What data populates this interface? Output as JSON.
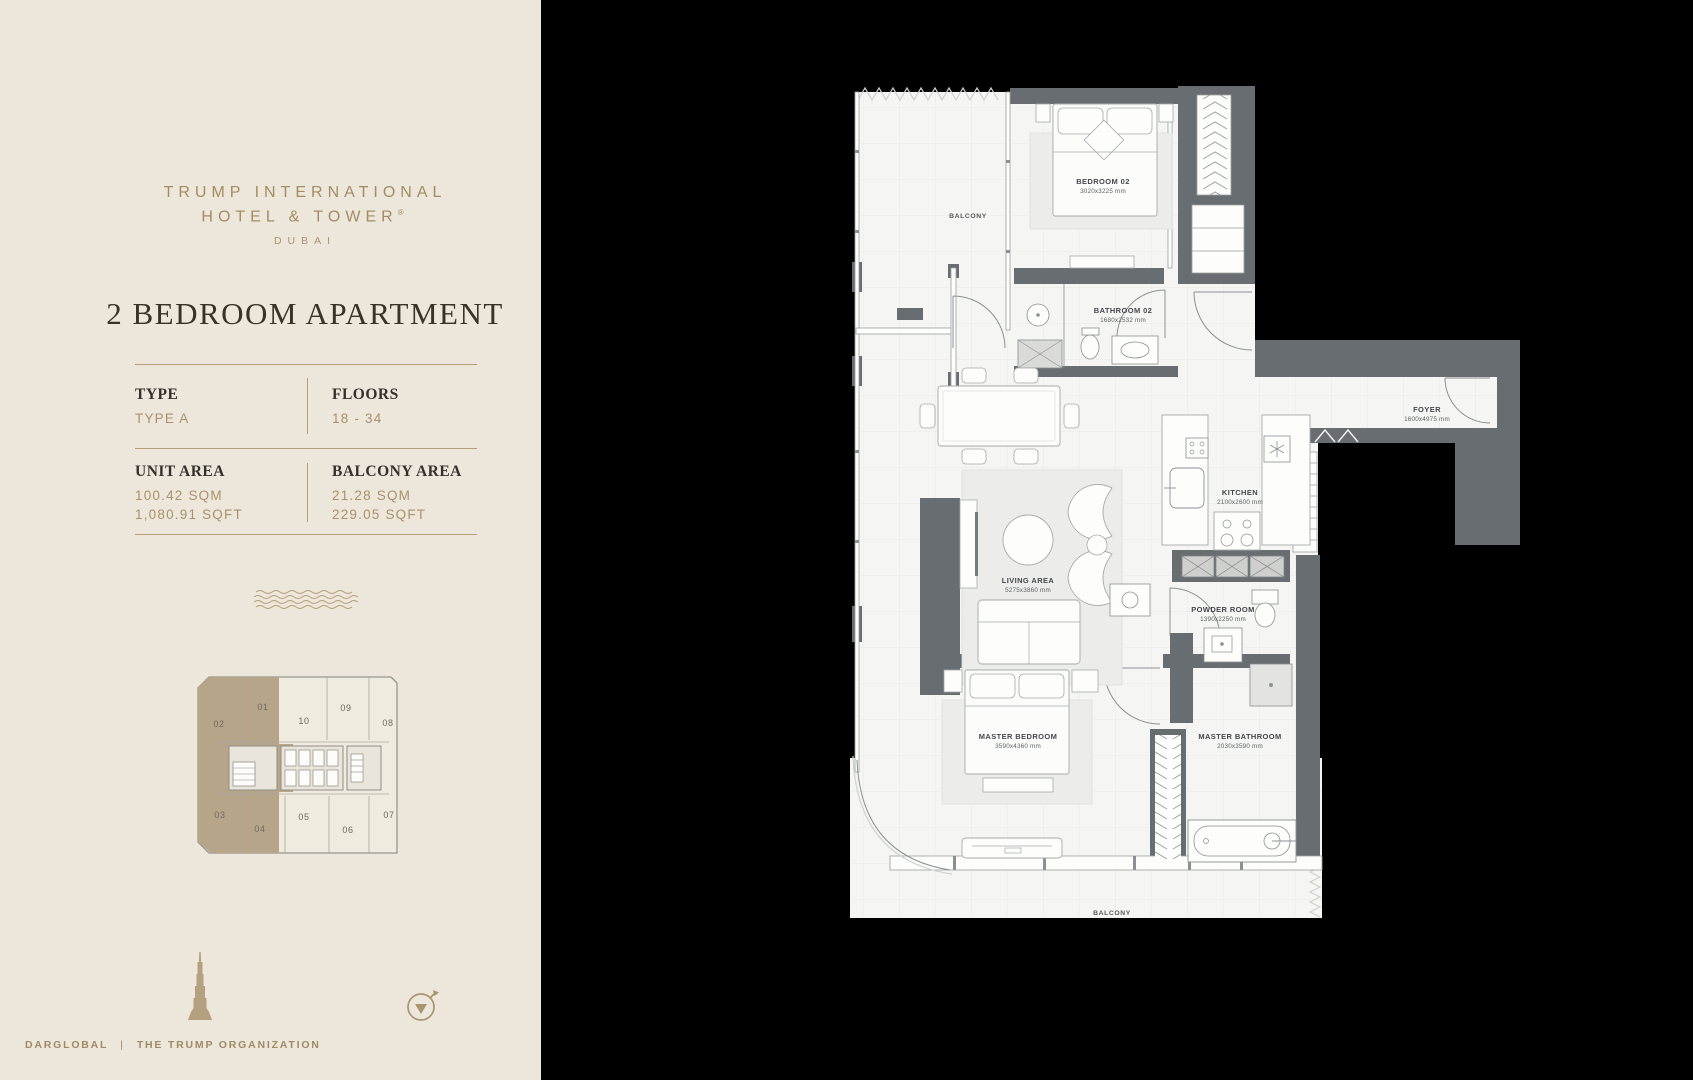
{
  "panel": {
    "brand_line1": "TRUMP INTERNATIONAL",
    "brand_line2": "HOTEL & TOWER",
    "brand_reg": "®",
    "brand_city": "DUBAI",
    "title": "2 BEDROOM APARTMENT",
    "specs": [
      {
        "label": "TYPE",
        "values": [
          "TYPE A"
        ]
      },
      {
        "label": "FLOORS",
        "values": [
          "18 - 34"
        ]
      },
      {
        "label": "UNIT AREA",
        "values": [
          "100.42 SQM",
          "1,080.91 SQFT"
        ]
      },
      {
        "label": "BALCONY AREA",
        "values": [
          "21.28 SQM",
          "229.05 SQFT"
        ]
      }
    ],
    "footer_left": "DARGLOBAL",
    "footer_sep": "|",
    "footer_right": "THE TRUMP ORGANIZATION"
  },
  "key_plan": {
    "units": [
      "01",
      "02",
      "03",
      "04",
      "05",
      "06",
      "07",
      "08",
      "09",
      "10"
    ],
    "highlighted_units": [
      "02",
      "03"
    ],
    "highlight_color": "#b7a58a"
  },
  "floor_plan": {
    "rooms": [
      {
        "name": "BALCONY",
        "dims": ""
      },
      {
        "name": "BEDROOM 02",
        "dims": "3020x3225 mm"
      },
      {
        "name": "BATHROOM 02",
        "dims": "1680x2532 mm"
      },
      {
        "name": "FOYER",
        "dims": "1600x4975 mm"
      },
      {
        "name": "KITCHEN",
        "dims": "2100x2600 mm"
      },
      {
        "name": "LIVING AREA",
        "dims": "5275x3860 mm"
      },
      {
        "name": "POWDER ROOM",
        "dims": "1390x2250 mm"
      },
      {
        "name": "MASTER BEDROOM",
        "dims": "3590x4360 mm"
      },
      {
        "name": "MASTER BATHROOM",
        "dims": "2030x3590 mm"
      },
      {
        "name": "BALCONY",
        "dims": ""
      }
    ],
    "colors": {
      "wall": "#686d71",
      "floor": "#f5f5f3",
      "accent": "#b2a07f"
    }
  }
}
